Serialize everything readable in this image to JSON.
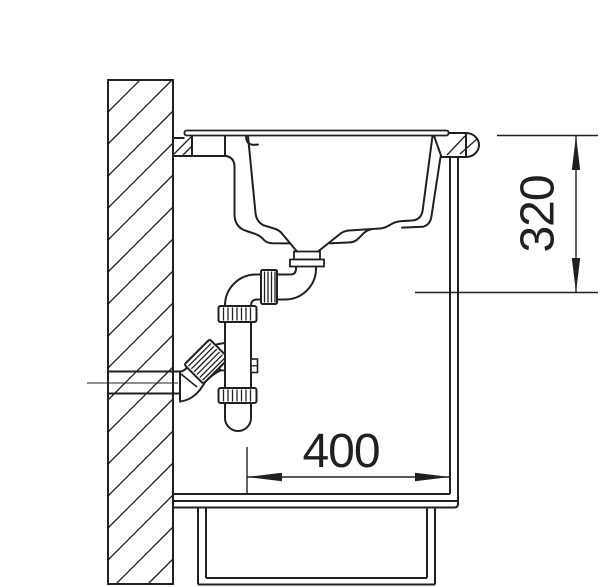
{
  "diagram": {
    "type": "technical-drawing",
    "subject": "kitchen-sink-cabinet-cross-section-with-trap",
    "background_color": "#ffffff",
    "line_color": "#231f20",
    "dimensions": {
      "cabinet_width": {
        "label": "400",
        "orientation": "horizontal"
      },
      "installation_depth": {
        "label": "320",
        "orientation": "vertical"
      }
    }
  }
}
